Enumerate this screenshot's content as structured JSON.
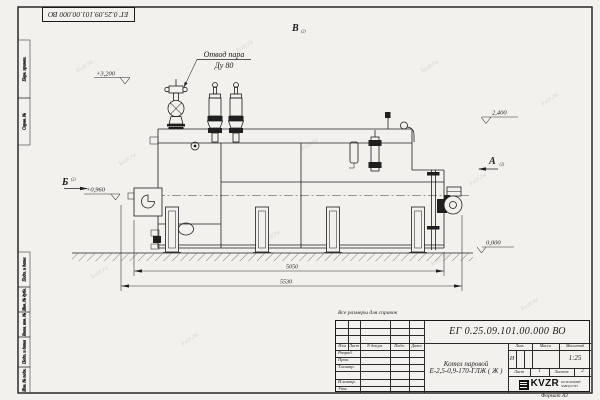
{
  "watermark": "kvzr.ru",
  "frame": {
    "side_labels_top": [
      "Перв. примен.",
      "Справ. №"
    ],
    "side_labels_bottom": [
      "Подп. и дата",
      "Инв. № дубл.",
      "Взам. инв. №",
      "Подп. и дата",
      "Инв. № подл."
    ]
  },
  "drawing": {
    "callout": {
      "line1": "Отвод пара",
      "line2": "Ду 80"
    },
    "elevations": {
      "valves_top": "+3,200",
      "drum_top": "2,400",
      "axis": "+0,960",
      "ground": "0,000"
    },
    "dimensions": {
      "boiler_length": "5050",
      "overall_length": "5530"
    },
    "views": {
      "a": "А",
      "b": "Б",
      "v": "В",
      "sheet_ref": "(2)"
    }
  },
  "note": "Все размеры для справок",
  "title_block": {
    "designation": "ЕГ 0.25.09.101.00.000 ВО",
    "product": {
      "line1": "Котел паровой",
      "line2": "Е-2,5-0,9-170-ГЛЖ ( Ж )"
    },
    "columns": {
      "izm": "Изм",
      "list": "Лист",
      "doc": "N докум.",
      "podp": "Подп.",
      "data": "Дата"
    },
    "rows": {
      "r1": "Разраб.",
      "r2": "Пров.",
      "r3": "Т.контр.",
      "r4": "Н.контр.",
      "r5": "Утв."
    },
    "lit": {
      "label": "Лит.",
      "value": "И"
    },
    "mass": {
      "label": "Масса"
    },
    "scale": {
      "label": "Масштаб",
      "value": "1:25"
    },
    "sheet": {
      "label": "Лист",
      "value": "1"
    },
    "sheets": {
      "label": "Листов",
      "value": "2"
    },
    "company": {
      "logo": "KVZR",
      "line1": "КОТЕЛЬНЫЙ",
      "line2": "ЗАВОД РЭП"
    },
    "format": "Формат А3"
  }
}
